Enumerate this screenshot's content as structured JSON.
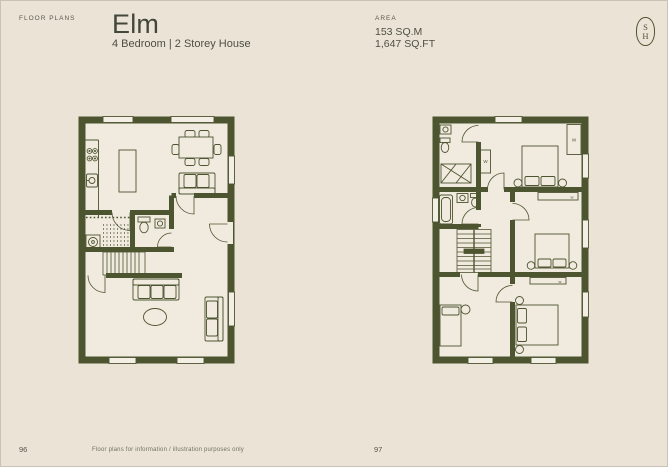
{
  "page": {
    "background_color": "#ebe3d6",
    "wall_color": "#4d5430",
    "floor_color": "#f1ebdf",
    "text_color": "#45483a"
  },
  "header": {
    "section_label": "FLOOR PLANS",
    "title": "Elm",
    "subtitle": "4 Bedroom | 2 Storey House",
    "area_label": "AREA",
    "area_sqm": "153 SQ.M",
    "area_sqft": "1,647 SQ.FT"
  },
  "logo": {
    "letter_top": "S",
    "letter_bottom": "H"
  },
  "plans": {
    "ground_floor": {
      "page_number": "96"
    },
    "first_floor": {
      "page_number": "97",
      "wardrobe_label": "W",
      "wardrobe_label_small": "w"
    }
  },
  "footer": {
    "left_page_number": "96",
    "right_page_number": "97",
    "disclaimer": "Floor plans for information / illustration purposes only"
  }
}
